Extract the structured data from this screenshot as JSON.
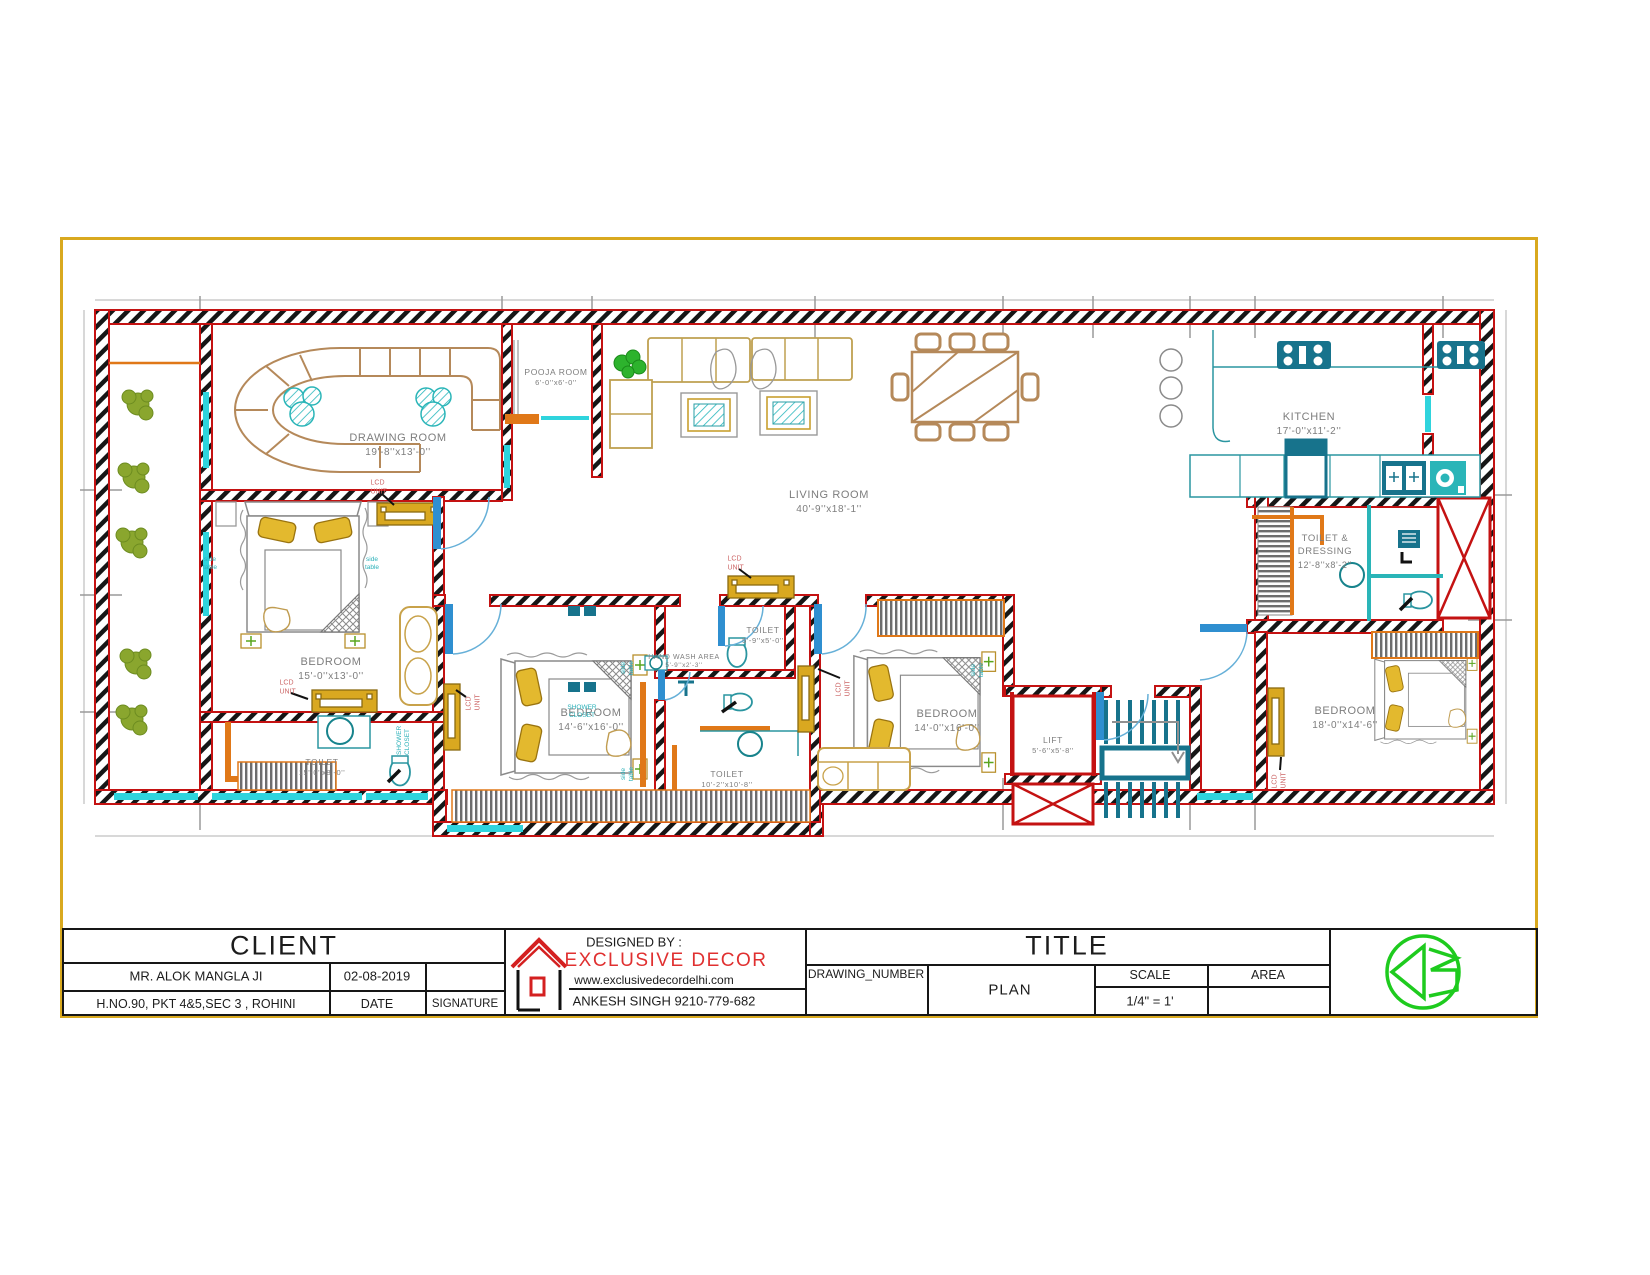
{
  "sheet": {
    "border_color": "#d9a91f"
  },
  "plan": {
    "rooms": [
      {
        "name": "DRAWING ROOM",
        "dims": "19'-8''x13'-0''"
      },
      {
        "name": "POOJA ROOM",
        "dims": "6'-0''x6'-0''"
      },
      {
        "name": "LIVING ROOM",
        "dims": "40'-9''x18'-1''"
      },
      {
        "name": "KITCHEN",
        "dims": "17'-0''x11'-2''"
      },
      {
        "name": "TOILET & DRESSING",
        "dims": "12'-8''x8'-2''"
      },
      {
        "name": "BEDROOM",
        "dims": "15'-0''x13'-0''"
      },
      {
        "name": "TOILET",
        "dims": "15'-0''x8'-0''"
      },
      {
        "name": "BEDROOM",
        "dims": "14'-6''x16'-0''"
      },
      {
        "name": "TOILET",
        "dims": "5'-9''x5'-0''"
      },
      {
        "name": "HAND WASH AREA",
        "dims": "5'-9''x2'-3''"
      },
      {
        "name": "TOILET",
        "dims": "10'-2''x10'-8''"
      },
      {
        "name": "BEDROOM",
        "dims": "14'-0''x16'-0''"
      },
      {
        "name": "LIFT",
        "dims": "5'-6''x5'-8''"
      },
      {
        "name": "BEDROOM",
        "dims": "18'-0''x14'-6''"
      }
    ],
    "annotations": {
      "lcd_unit": "LCD UNIT",
      "shower_closet": "SHOWER CLOSET",
      "side_table": "side table"
    }
  },
  "title_block": {
    "client": {
      "header": "CLIENT",
      "name": "MR. ALOK MANGLA JI",
      "date": "02-08-2019",
      "address": "H.NO.90, PKT 4&5,SEC 3 , ROHINI",
      "date_label": "DATE",
      "signature_label": "SIGNATURE"
    },
    "designer": {
      "heading": "DESIGNED BY :",
      "company": "EXCLUSIVE DECOR",
      "website": "www.exclusivedecordelhi.com",
      "contact": "ANKESH SINGH 9210-779-682"
    },
    "title": {
      "header": "TITLE",
      "drawing_number_label": "DRAWING_NUMBER",
      "plan_label": "PLAN",
      "scale_label": "SCALE",
      "scale_value": "1/4\" = 1'",
      "area_label": "AREA"
    }
  }
}
